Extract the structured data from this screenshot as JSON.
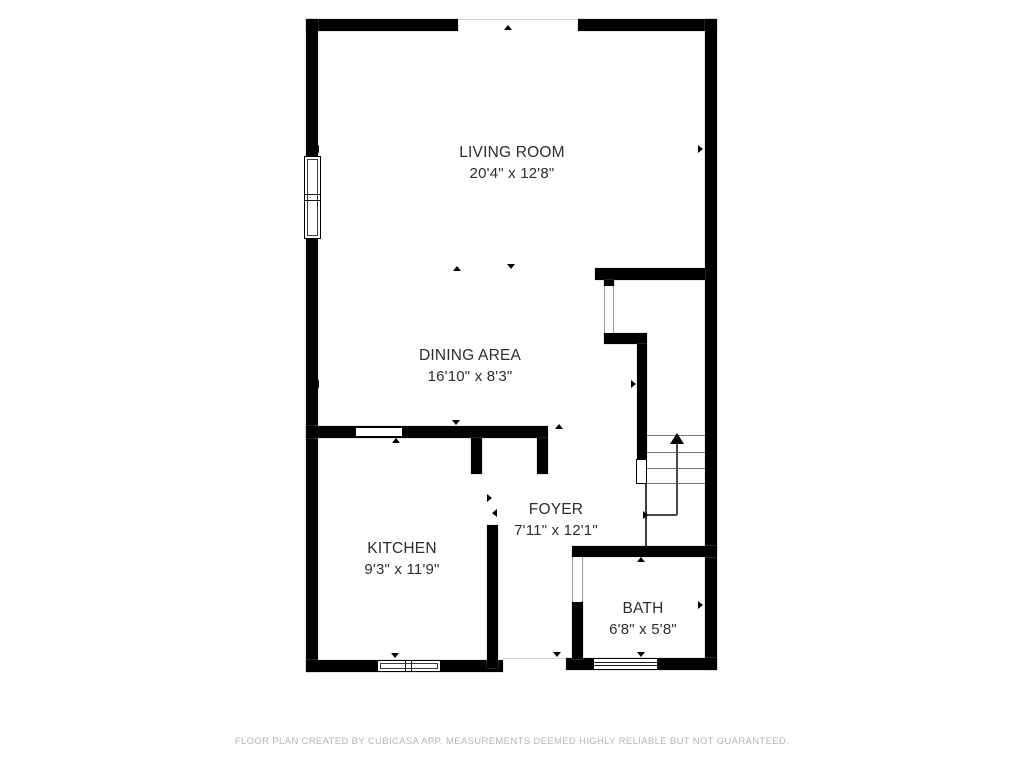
{
  "floorplan": {
    "rooms": {
      "living_room": {
        "name": "LIVING ROOM",
        "dimensions": "20'4\" x 12'8\""
      },
      "dining_area": {
        "name": "DINING AREA",
        "dimensions": "16'10\" x 8'3\""
      },
      "kitchen": {
        "name": "KITCHEN",
        "dimensions": "9'3\" x 11'9\""
      },
      "foyer": {
        "name": "FOYER",
        "dimensions": "7'11\" x 12'1\""
      },
      "bath": {
        "name": "BATH",
        "dimensions": "6'8\" x 5'8\""
      }
    },
    "colors": {
      "wall": "#000000",
      "background": "#ffffff",
      "label_text": "#2d2d2d",
      "footer_text": "#b5b5b5",
      "stair_lines": "#777777"
    }
  },
  "footer": {
    "disclaimer": "FLOOR PLAN CREATED BY CUBICASA APP. MEASUREMENTS DEEMED HIGHLY RELIABLE BUT NOT GUARANTEED."
  }
}
